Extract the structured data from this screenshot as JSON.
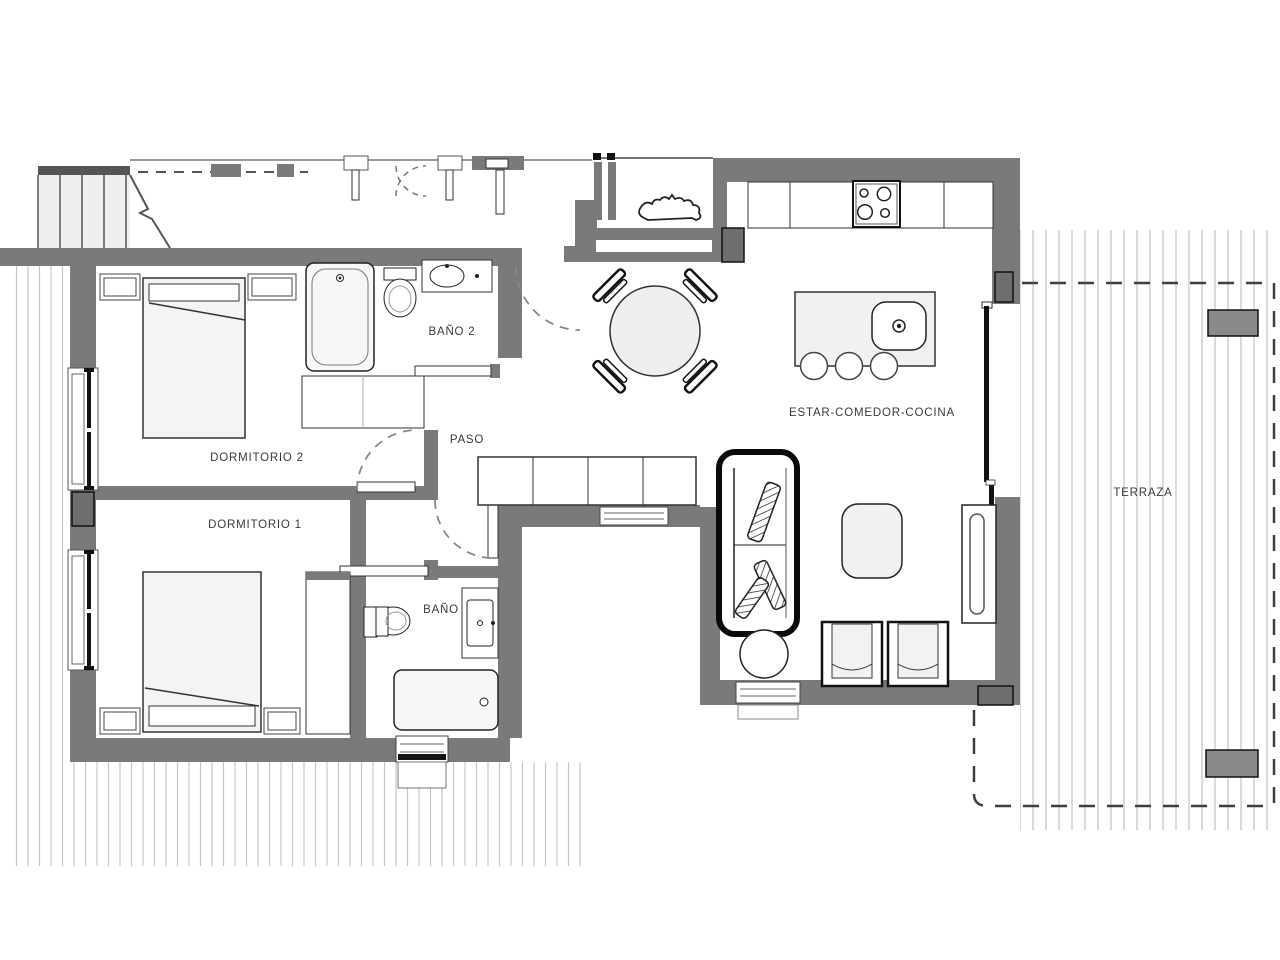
{
  "title": "Floor plan - 2 bedroom apartment with terrace",
  "rooms": [
    {
      "id": "bano2",
      "label": "BAÑO 2",
      "x": 452,
      "y": 332
    },
    {
      "id": "paso",
      "label": "PASO",
      "x": 467,
      "y": 440
    },
    {
      "id": "dormitorio2",
      "label": "DORMITORIO 2",
      "x": 257,
      "y": 458
    },
    {
      "id": "dormitorio1",
      "label": "DORMITORIO 1",
      "x": 255,
      "y": 525
    },
    {
      "id": "bano",
      "label": "BAÑO",
      "x": 441,
      "y": 610
    },
    {
      "id": "estar",
      "label": "ESTAR-COMEDOR-COCINA",
      "x": 872,
      "y": 413
    },
    {
      "id": "terraza",
      "label": "TERRAZA",
      "x": 1143,
      "y": 493
    }
  ],
  "fixtures": [
    {
      "name": "staircase",
      "room": "common-landing"
    },
    {
      "name": "double-bed",
      "room": "dormitorio2"
    },
    {
      "name": "double-bed",
      "room": "dormitorio1"
    },
    {
      "name": "bathtub",
      "room": "bano2"
    },
    {
      "name": "bathtub",
      "room": "bano"
    },
    {
      "name": "toilet",
      "room": "bano2"
    },
    {
      "name": "toilet",
      "room": "bano"
    },
    {
      "name": "washbasin",
      "room": "bano2"
    },
    {
      "name": "washbasin",
      "room": "bano"
    },
    {
      "name": "wardrobe",
      "room": "dormitorio1"
    },
    {
      "name": "round-dining-table-4-chairs",
      "room": "estar"
    },
    {
      "name": "kitchen-counter-cooktop-4-burners",
      "room": "estar"
    },
    {
      "name": "island-with-sink-3-stools",
      "room": "estar"
    },
    {
      "name": "sofa",
      "room": "estar"
    },
    {
      "name": "coffee-table",
      "room": "estar"
    },
    {
      "name": "armchair",
      "room": "estar"
    },
    {
      "name": "armchair",
      "room": "estar"
    },
    {
      "name": "side-table",
      "room": "estar"
    },
    {
      "name": "tv-unit",
      "room": "estar"
    },
    {
      "name": "sideboard",
      "room": "estar"
    },
    {
      "name": "planter",
      "room": "terraza"
    },
    {
      "name": "planter",
      "room": "terraza"
    }
  ],
  "theme": {
    "wall": "#7a7a7a",
    "wallDark": "#6e6e6e",
    "line": "#222222",
    "furniture": "#f2f2f2",
    "hatch": "#c6c6c6",
    "stairTop": "#555555",
    "text": "#3a3a3a",
    "background": "#ffffff"
  }
}
